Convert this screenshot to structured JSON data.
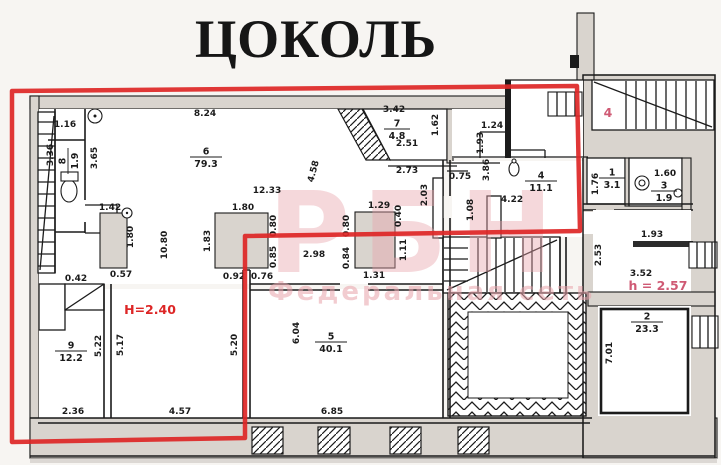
{
  "title": "ЦОКОЛЬ",
  "colors": {
    "annotation_red": "#dd2626",
    "annotation_pink": "#cf5a74",
    "watermark_pink": "#e9a3ab",
    "wall_gray": "#d9d4ce",
    "ink": "#1b1b1b",
    "paper": "#f7f5f2"
  },
  "watermark": {
    "main": "РБН",
    "sub": "Федеральная сеть"
  },
  "red_annotations": [
    {
      "text": "H=2.40",
      "x": 150,
      "y": 314,
      "style": "red"
    },
    {
      "text": "h = 2.57",
      "x": 658,
      "y": 290,
      "style": "pink"
    },
    {
      "text": "4",
      "x": 608,
      "y": 117,
      "style": "pink"
    }
  ],
  "room_labels": [
    {
      "number": "8",
      "area": "1.9",
      "x": 68,
      "y": 161,
      "rot": -90
    },
    {
      "number": "6",
      "area": "79.3",
      "x": 206,
      "y": 157,
      "rot": 0
    },
    {
      "number": "7",
      "area": "4.8",
      "x": 397,
      "y": 129,
      "rot": 0
    },
    {
      "number": "4",
      "area": "11.1",
      "x": 541,
      "y": 181,
      "rot": 0
    },
    {
      "number": "1",
      "area": "3.1",
      "x": 612,
      "y": 178,
      "rot": 0
    },
    {
      "number": "3",
      "area": "1.9",
      "x": 664,
      "y": 191,
      "rot": 0
    },
    {
      "number": "9",
      "area": "12.2",
      "x": 71,
      "y": 351,
      "rot": 0
    },
    {
      "number": "5",
      "area": "40.1",
      "x": 331,
      "y": 342,
      "rot": 0
    },
    {
      "number": "2",
      "area": "23.3",
      "x": 647,
      "y": 322,
      "rot": 0
    }
  ],
  "dimension_labels": [
    {
      "text": "1.16",
      "x": 65,
      "y": 127,
      "rot": 0
    },
    {
      "text": "8.24",
      "x": 205,
      "y": 116,
      "rot": 0
    },
    {
      "text": "3.36",
      "x": 53,
      "y": 155,
      "rot": -90
    },
    {
      "text": "3.65",
      "x": 97,
      "y": 158,
      "rot": -90
    },
    {
      "text": "1.42",
      "x": 110,
      "y": 210,
      "rot": 0
    },
    {
      "text": "1.80",
      "x": 133,
      "y": 237,
      "rot": -90
    },
    {
      "text": "0.42",
      "x": 76,
      "y": 281,
      "rot": 0
    },
    {
      "text": "0.57",
      "x": 121,
      "y": 277,
      "rot": 0
    },
    {
      "text": "10.80",
      "x": 167,
      "y": 245,
      "rot": -90
    },
    {
      "text": "12.33",
      "x": 267,
      "y": 193,
      "rot": 0
    },
    {
      "text": "1.80",
      "x": 243,
      "y": 210,
      "rot": 0
    },
    {
      "text": "1.83",
      "x": 210,
      "y": 241,
      "rot": -90
    },
    {
      "text": "0.80",
      "x": 276,
      "y": 226,
      "rot": -90
    },
    {
      "text": "0.85",
      "x": 276,
      "y": 257,
      "rot": -90
    },
    {
      "text": "0.92",
      "x": 234,
      "y": 279,
      "rot": 0
    },
    {
      "text": "0.76",
      "x": 262,
      "y": 279,
      "rot": 0
    },
    {
      "text": "2.98",
      "x": 314,
      "y": 257,
      "rot": 0
    },
    {
      "text": "4.58",
      "x": 316,
      "y": 172,
      "rot": -75
    },
    {
      "text": "3.42",
      "x": 394,
      "y": 112,
      "rot": 0
    },
    {
      "text": "1.62",
      "x": 438,
      "y": 125,
      "rot": -90
    },
    {
      "text": "2.51",
      "x": 407,
      "y": 146,
      "rot": 0
    },
    {
      "text": "2.73",
      "x": 407,
      "y": 173,
      "rot": 0
    },
    {
      "text": "0.75",
      "x": 460,
      "y": 179,
      "rot": 0
    },
    {
      "text": "1.24",
      "x": 492,
      "y": 128,
      "rot": 0
    },
    {
      "text": "1.93",
      "x": 483,
      "y": 143,
      "rot": -90
    },
    {
      "text": "3.86",
      "x": 489,
      "y": 170,
      "rot": -90
    },
    {
      "text": "2.03",
      "x": 427,
      "y": 195,
      "rot": -90
    },
    {
      "text": "1.29",
      "x": 379,
      "y": 208,
      "rot": 0
    },
    {
      "text": "0.40",
      "x": 401,
      "y": 216,
      "rot": -90
    },
    {
      "text": "0.80",
      "x": 349,
      "y": 226,
      "rot": -90
    },
    {
      "text": "0.84",
      "x": 349,
      "y": 258,
      "rot": -90
    },
    {
      "text": "1.31",
      "x": 374,
      "y": 278,
      "rot": 0
    },
    {
      "text": "1.11",
      "x": 406,
      "y": 250,
      "rot": -90
    },
    {
      "text": "1.08",
      "x": 473,
      "y": 210,
      "rot": -90
    },
    {
      "text": "4.22",
      "x": 512,
      "y": 202,
      "rot": 0
    },
    {
      "text": "1.76",
      "x": 598,
      "y": 184,
      "rot": -90
    },
    {
      "text": "1.60",
      "x": 665,
      "y": 176,
      "rot": 0
    },
    {
      "text": "2.53",
      "x": 601,
      "y": 255,
      "rot": -90
    },
    {
      "text": "1.93",
      "x": 652,
      "y": 237,
      "rot": 0
    },
    {
      "text": "3.52",
      "x": 641,
      "y": 276,
      "rot": 0
    },
    {
      "text": "7.01",
      "x": 612,
      "y": 353,
      "rot": -90
    },
    {
      "text": "5.22",
      "x": 101,
      "y": 346,
      "rot": -90
    },
    {
      "text": "5.17",
      "x": 123,
      "y": 345,
      "rot": -90
    },
    {
      "text": "5.20",
      "x": 237,
      "y": 345,
      "rot": -90
    },
    {
      "text": "2.36",
      "x": 73,
      "y": 414,
      "rot": 0
    },
    {
      "text": "4.57",
      "x": 180,
      "y": 414,
      "rot": 0
    },
    {
      "text": "6.04",
      "x": 299,
      "y": 333,
      "rot": -90
    },
    {
      "text": "6.85",
      "x": 332,
      "y": 414,
      "rot": 0
    }
  ]
}
